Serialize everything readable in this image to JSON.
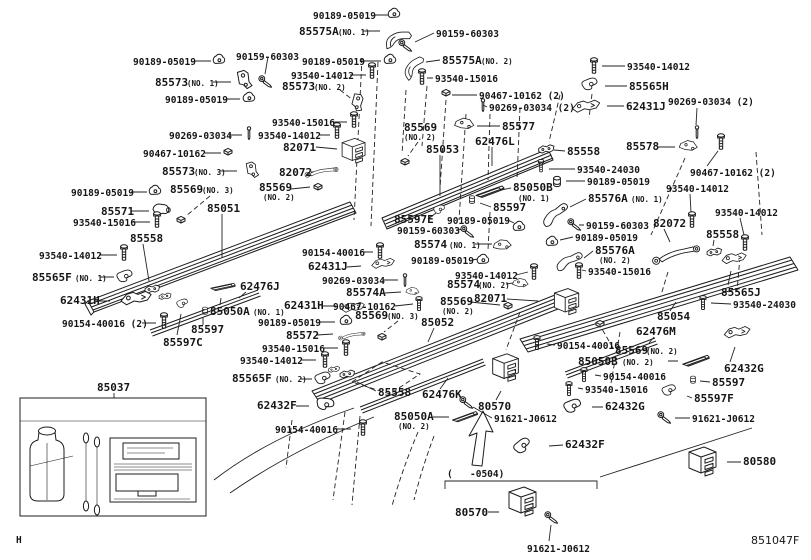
{
  "colors": {
    "ink": "#1c1c1c",
    "background": "#ffffff"
  },
  "footer": {
    "diagram_code": "851047F"
  },
  "page_marker": "H",
  "labels": {
    "t01": "90189-05019",
    "t02": "85575A",
    "t03": "(NO. 1)",
    "t04": "90159-60303",
    "t05": "90189-05019",
    "t06": "85573",
    "t07": "(NO. 1)",
    "t08": "90159-60303",
    "t09": "90189-05019",
    "t10": "85575A",
    "t11": "(NO. 2)",
    "t12": "93540-14012",
    "t13": "93540-15016",
    "t14": "85573",
    "t15": "(NO. 2)",
    "t16": "90189-05019",
    "t17": "90467-10162 (2)",
    "t18": "90269-03034 (2)",
    "t19": "85577",
    "t20": "93540-15016",
    "t21": "90269-03034",
    "t22": "93540-14012",
    "t23": "82071",
    "t24": "82072",
    "t25": "85569",
    "t26": "(NO. 2)",
    "t27": "85053",
    "t28": "62476L",
    "t29": "85558",
    "t30": "93540-24030",
    "t31": "90189-05019",
    "t32": "85050B",
    "t33": "(NO. 1)",
    "t34": "85576A",
    "t35": "(NO. 1)",
    "t36": "85597E",
    "t37": "85597",
    "t38": "90189-05019",
    "t39": "90159-60303",
    "t40": "85574",
    "t41": "(NO. 1)",
    "t42": "90159-60303",
    "t43": "90189-05019",
    "t44": "85576A",
    "t45": "(NO. 2)",
    "t46": "90189-05019",
    "t47": "93540-14012",
    "t48": "85574",
    "t49": "(NO. 2)",
    "t50": "93540-15016",
    "t51": "93540-14012",
    "t52": "82072",
    "t53": "93540-14012",
    "t54": "85558",
    "t55": "85565J",
    "t56": "93540-24030",
    "t57": "85578",
    "t58": "90467-10162 (2)",
    "t59": "93540-14012",
    "t60": "85565H",
    "t61": "62431J",
    "t62": "90269-03034 (2)",
    "t63": "90467-10162",
    "t64": "85573",
    "t65": "(NO. 3)",
    "t66": "90189-05019",
    "t67": "85569",
    "t68": "(NO. 3)",
    "t69": "85571",
    "t70": "93540-15016",
    "t71": "85051",
    "t72": "85558",
    "t73": "93540-14012",
    "t74": "85565F",
    "t75": "(NO. 1)",
    "t76": "62431H",
    "t77": "90154-40016 (2)",
    "t78": "85597",
    "t79": "85597C",
    "t80": "62476J",
    "t81": "85050A",
    "t82": "(NO. 1)",
    "t83": "62431H",
    "t84": "90189-05019",
    "t85": "85572",
    "t86": "93540-15016",
    "t87": "93540-14012",
    "t88": "85565F",
    "t89": "(NO. 2)",
    "t90": "62432F",
    "t91": "85037",
    "t92": "90154-40016",
    "t93": "85569",
    "t94": "(NO. 2)",
    "t95": "90154-40016",
    "t96": "62431J",
    "t97": "90269-03034",
    "t98": "85574A",
    "t99": "90467-10162",
    "t100": "85569",
    "t101": "(NO. 3)",
    "t102": "85052",
    "t103": "85569",
    "t104": "(NO. 2)",
    "t105": "82071",
    "t106": "85558",
    "t107": "62476K",
    "t108": "85050A",
    "t109": "(NO. 2)",
    "t110": "80570",
    "t111": "91621-J0612",
    "t112": "(",
    "t113": "-0504)",
    "t114": "80570",
    "t115": "91621-J0612",
    "t116": "90154-40016",
    "t117": "85569",
    "t118": "(NO. 2)",
    "t119": "85050B",
    "t120": "(NO. 2)",
    "t121": "90154-40016",
    "t122": "93540-15016",
    "t123": "62432G",
    "t124": "62432F",
    "t125": "62432G",
    "t126": "85597",
    "t127": "85597F",
    "t128": "91621-J0612",
    "t129": "80580",
    "t130": "85054",
    "t131": "62476M"
  }
}
